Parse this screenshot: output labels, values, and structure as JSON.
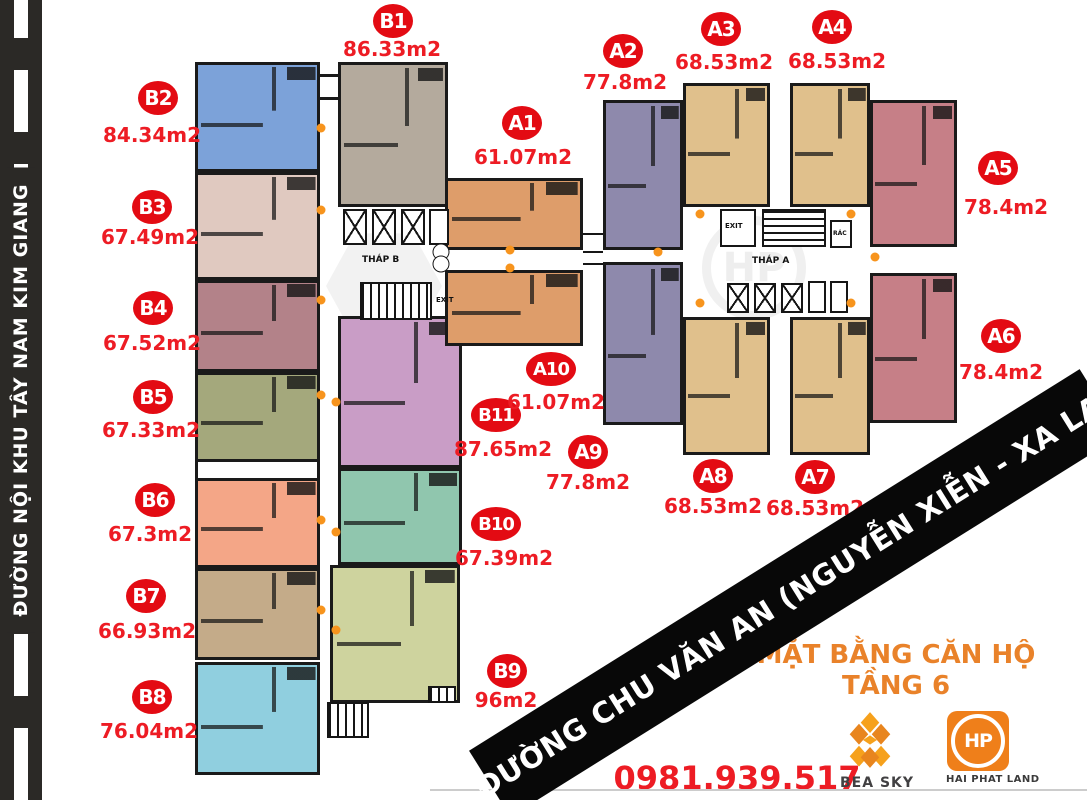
{
  "road": {
    "name": "ĐƯỜNG NỘI KHU TÂY NAM KIM GIANG"
  },
  "banner": {
    "text": "ĐƯỜNG CHU VĂN AN (NGUYỄN XIỄN - XA LA)"
  },
  "title": {
    "line1": "MẶT BẰNG CĂN HỘ",
    "line2": "TẦNG 6"
  },
  "contact": {
    "phone": "0981.939.517"
  },
  "logos": {
    "bea_sky": "BEA SKY",
    "hai_phat_land": "HAI PHAT LAND",
    "hp_monogram": "HP"
  },
  "labels": {
    "thap_a": "THÁP A",
    "thap_b": "THÁP B",
    "exit_a": "EXIT",
    "exit_b": "EXIT",
    "rac": "RÁC"
  },
  "colors": {
    "badge_red": "#e30b13",
    "area_red": "#ed1c24",
    "title_orange": "#e9822a",
    "banner_black": "#080808",
    "road_dark": "#2b2926",
    "wall_dark": "#1a1a1a",
    "door_orange": "#f7941d"
  },
  "units": [
    {
      "id": "B2",
      "area": "84.34m2",
      "color": "#7ca2d9",
      "rect": [
        195,
        62,
        125,
        110
      ],
      "badge": [
        158,
        98
      ],
      "label": [
        152,
        135
      ]
    },
    {
      "id": "B3",
      "area": "67.49m2",
      "color": "#e0c9c0",
      "rect": [
        195,
        172,
        125,
        108
      ],
      "badge": [
        152,
        207
      ],
      "label": [
        150,
        237
      ]
    },
    {
      "id": "B4",
      "area": "67.52m2",
      "color": "#b38289",
      "rect": [
        195,
        280,
        125,
        92
      ],
      "badge": [
        153,
        308
      ],
      "label": [
        152,
        343
      ]
    },
    {
      "id": "B5",
      "area": "67.33m2",
      "color": "#a4a87c",
      "rect": [
        195,
        372,
        125,
        90
      ],
      "badge": [
        153,
        397
      ],
      "label": [
        151,
        430
      ]
    },
    {
      "id": "B6",
      "area": "67.3m2",
      "color": "#f4a687",
      "rect": [
        195,
        478,
        125,
        90
      ],
      "badge": [
        155,
        500
      ],
      "label": [
        150,
        534
      ]
    },
    {
      "id": "B7",
      "area": "66.93m2",
      "color": "#c4ab89",
      "rect": [
        195,
        568,
        125,
        92
      ],
      "badge": [
        146,
        596
      ],
      "label": [
        147,
        631
      ]
    },
    {
      "id": "B8",
      "area": "76.04m2",
      "color": "#90cfdf",
      "rect": [
        195,
        662,
        125,
        113
      ],
      "badge": [
        152,
        697
      ],
      "label": [
        149,
        731
      ]
    },
    {
      "id": "B1",
      "area": "86.33m2",
      "color": "#b4aa9d",
      "rect": [
        338,
        62,
        110,
        145
      ],
      "badge": [
        393,
        21
      ],
      "label": [
        392,
        49
      ]
    },
    {
      "id": "B11",
      "area": "87.65m2",
      "color": "#c99dc6",
      "rect": [
        338,
        316,
        124,
        152
      ],
      "badge": [
        496,
        415
      ],
      "label": [
        503,
        449
      ]
    },
    {
      "id": "B10",
      "area": "67.39m2",
      "color": "#90c6ae",
      "rect": [
        338,
        468,
        124,
        97
      ],
      "badge": [
        496,
        524
      ],
      "label": [
        504,
        558
      ]
    },
    {
      "id": "B9",
      "area": "96m2",
      "color": "#ced39e",
      "rect": [
        330,
        565,
        130,
        138
      ],
      "badge": [
        507,
        671
      ],
      "label": [
        506,
        700
      ]
    },
    {
      "id": "A1",
      "area": "61.07m2",
      "color": "#de9d6a",
      "rect": [
        445,
        178,
        138,
        72
      ],
      "badge": [
        522,
        123
      ],
      "label": [
        523,
        157
      ]
    },
    {
      "id": "A10",
      "area": "61.07m2",
      "color": "#de9d6a",
      "rect": [
        445,
        270,
        138,
        76
      ],
      "badge": [
        551,
        369
      ],
      "label": [
        556,
        402
      ]
    },
    {
      "id": "A2",
      "area": "77.8m2",
      "color": "#8e89ac",
      "rect": [
        603,
        100,
        80,
        150
      ],
      "badge": [
        623,
        51
      ],
      "label": [
        625,
        82
      ]
    },
    {
      "id": "A9",
      "area": "77.8m2",
      "color": "#8e89ac",
      "rect": [
        603,
        262,
        80,
        163
      ],
      "badge": [
        588,
        452
      ],
      "label": [
        588,
        482
      ]
    },
    {
      "id": "A3",
      "area": "68.53m2",
      "color": "#e0c08c",
      "rect": [
        683,
        83,
        87,
        124
      ],
      "badge": [
        721,
        29
      ],
      "label": [
        724,
        62
      ]
    },
    {
      "id": "A4",
      "area": "68.53m2",
      "color": "#e0c08c",
      "rect": [
        790,
        83,
        80,
        124
      ],
      "badge": [
        832,
        27
      ],
      "label": [
        837,
        61
      ]
    },
    {
      "id": "A5",
      "area": "78.4m2",
      "color": "#c67f87",
      "rect": [
        870,
        100,
        87,
        147
      ],
      "badge": [
        998,
        168
      ],
      "label": [
        1006,
        207
      ]
    },
    {
      "id": "A6",
      "area": "78.4m2",
      "color": "#c67f87",
      "rect": [
        870,
        273,
        87,
        150
      ],
      "badge": [
        1001,
        336
      ],
      "label": [
        1001,
        372
      ]
    },
    {
      "id": "A8",
      "area": "68.53m2",
      "color": "#e0c08c",
      "rect": [
        683,
        317,
        87,
        138
      ],
      "badge": [
        713,
        476
      ],
      "label": [
        713,
        506
      ]
    },
    {
      "id": "A7",
      "area": "68.53m2",
      "color": "#e0c08c",
      "rect": [
        790,
        317,
        80,
        138
      ],
      "badge": [
        815,
        477
      ],
      "label": [
        815,
        508
      ]
    }
  ],
  "door_markers": [
    [
      321,
      128
    ],
    [
      321,
      210
    ],
    [
      321,
      300
    ],
    [
      321,
      395
    ],
    [
      321,
      520
    ],
    [
      321,
      610
    ],
    [
      336,
      402
    ],
    [
      336,
      532
    ],
    [
      336,
      630
    ],
    [
      510,
      250
    ],
    [
      510,
      268
    ],
    [
      700,
      214
    ],
    [
      700,
      303
    ],
    [
      851,
      214
    ],
    [
      851,
      303
    ],
    [
      658,
      252
    ],
    [
      875,
      257
    ]
  ]
}
